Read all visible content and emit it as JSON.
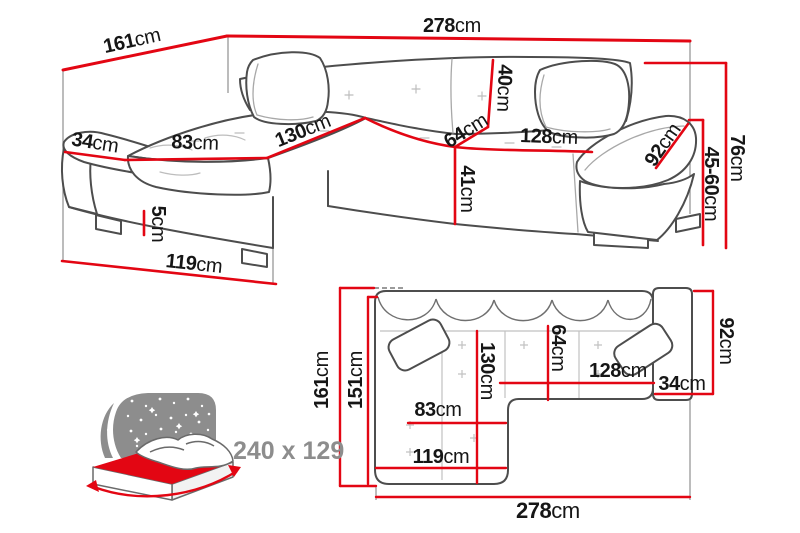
{
  "unit": "cm",
  "colors": {
    "dimension_red": "#e30613",
    "sketch_dark": "#4d4d4d",
    "sketch_light": "#b5b5b5",
    "label_ink": "#161616",
    "muted_gray": "#8d8d8d",
    "background": "#ffffff"
  },
  "perspective_view": {
    "labels": {
      "w161": {
        "num": "161",
        "unit": "cm"
      },
      "w278": {
        "num": "278",
        "unit": "cm"
      },
      "a34": {
        "num": "34",
        "unit": "cm"
      },
      "a83": {
        "num": "83",
        "unit": "cm"
      },
      "a130": {
        "num": "130",
        "unit": "cm"
      },
      "a64": {
        "num": "64",
        "unit": "cm"
      },
      "a40": {
        "num": "40",
        "unit": "cm"
      },
      "a128": {
        "num": "128",
        "unit": "cm"
      },
      "a92": {
        "num": "92",
        "unit": "cm"
      },
      "a41": {
        "num": "41",
        "unit": "cm"
      },
      "a5": {
        "num": "5",
        "unit": "cm"
      },
      "a119": {
        "num": "119",
        "unit": "cm"
      },
      "h76": {
        "num": "76",
        "unit": "cm"
      },
      "h4560": {
        "num": "45-60",
        "unit": "cm"
      }
    }
  },
  "top_view": {
    "labels": {
      "v161": {
        "num": "161",
        "unit": "cm"
      },
      "v151": {
        "num": "151",
        "unit": "cm"
      },
      "v130": {
        "num": "130",
        "unit": "cm"
      },
      "v64": {
        "num": "64",
        "unit": "cm"
      },
      "h128": {
        "num": "128",
        "unit": "cm"
      },
      "h34": {
        "num": "34",
        "unit": "cm"
      },
      "v92": {
        "num": "92",
        "unit": "cm"
      },
      "h83": {
        "num": "83",
        "unit": "cm"
      },
      "h119": {
        "num": "119",
        "unit": "cm"
      },
      "h278": {
        "num": "278",
        "unit": "cm"
      }
    }
  },
  "sleep_function": {
    "size_label": "240 x 129"
  }
}
